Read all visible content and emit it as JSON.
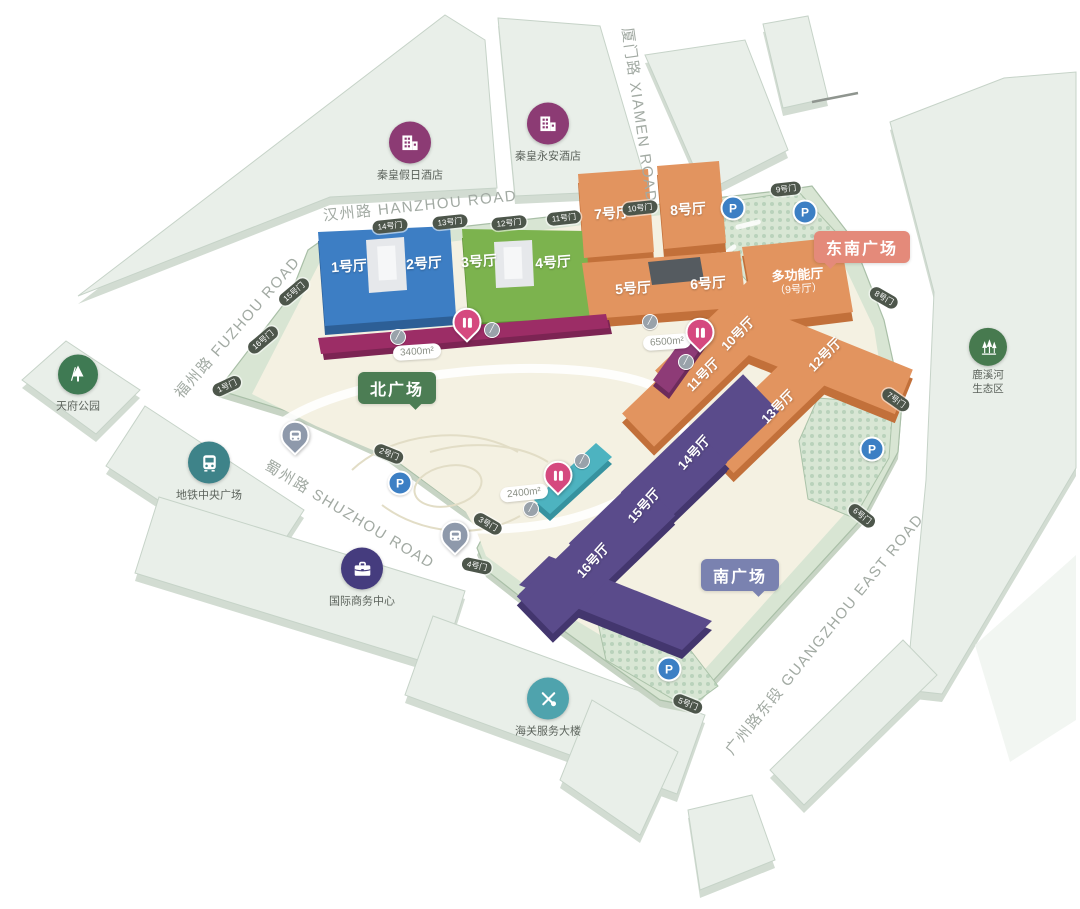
{
  "map": {
    "roads": {
      "hanzhou": {
        "label": "汉州路 HANZHOU ROAD"
      },
      "xiamen": {
        "label": "厦门路 XIAMEN ROAD"
      },
      "fuzhou": {
        "label": "福州路 FUZHOU ROAD"
      },
      "shuzhou": {
        "label": "蜀州路 SHUZHOU ROAD"
      },
      "guangzhou": {
        "label": "广州路东段 GUANGZHOU EAST ROAD"
      }
    },
    "halls": {
      "h1": {
        "label": "1号厅"
      },
      "h2": {
        "label": "2号厅"
      },
      "h3": {
        "label": "3号厅"
      },
      "h4": {
        "label": "4号厅"
      },
      "h5": {
        "label": "5号厅"
      },
      "h6": {
        "label": "6号厅"
      },
      "h7": {
        "label": "7号厅"
      },
      "h8": {
        "label": "8号厅"
      },
      "multi": {
        "line1": "多功能厅",
        "line2": "（9号厅）"
      },
      "h10": {
        "label": "10号厅"
      },
      "h11": {
        "label": "11号厅"
      },
      "h12": {
        "label": "12号厅"
      },
      "h13": {
        "label": "13号厅"
      },
      "h14": {
        "label": "14号厅"
      },
      "h15": {
        "label": "15号厅"
      },
      "h16": {
        "label": "16号厅"
      }
    },
    "plazas": {
      "north": {
        "label": "北广场",
        "color": "#4c7d54"
      },
      "southeast": {
        "label": "东南广场",
        "color": "#e48a7a"
      },
      "south": {
        "label": "南广场",
        "color": "#7a82b0"
      }
    },
    "gates": {
      "g1": {
        "label": "1号门"
      },
      "g2": {
        "label": "2号门"
      },
      "g3": {
        "label": "3号门"
      },
      "g4": {
        "label": "4号门"
      },
      "g5": {
        "label": "5号门"
      },
      "g6": {
        "label": "6号门"
      },
      "g7": {
        "label": "7号门"
      },
      "g8": {
        "label": "8号门"
      },
      "g9": {
        "label": "9号门"
      },
      "g10": {
        "label": "10号门"
      },
      "g11": {
        "label": "11号门"
      },
      "g12": {
        "label": "12号门"
      },
      "g13": {
        "label": "13号门"
      },
      "g14": {
        "label": "14号门"
      },
      "g15": {
        "label": "15号门"
      },
      "g16": {
        "label": "16号门"
      }
    },
    "areas": {
      "a3400": {
        "label": "3400m²"
      },
      "a6500": {
        "label": "6500m²"
      },
      "a2400": {
        "label": "2400m²"
      }
    },
    "landmarks": {
      "hotel_holiday": {
        "label": "秦皇假日酒店",
        "icon": "hotel-icon"
      },
      "hotel_yongan": {
        "label": "秦皇永安酒店",
        "icon": "hotel-icon"
      },
      "tianfu_park": {
        "label": "天府公园",
        "icon": "park-tree-icon"
      },
      "metro_plaza": {
        "label": "地铁中央广场",
        "icon": "metro-icon"
      },
      "business_center": {
        "label": "国际商务中心",
        "icon": "briefcase-icon"
      },
      "customs_building": {
        "label": "海关服务大楼",
        "icon": "customs-icon"
      },
      "luxi_eco": {
        "line1": "鹿溪河",
        "line2": "生态区",
        "icon": "eco-trees-icon"
      }
    },
    "markers": {
      "parking": {
        "label": "P",
        "count": 5,
        "color": "#3c7fc4"
      },
      "restaurant": {
        "icon": "fork-knife-icon",
        "count": 3,
        "color": "#d5497f"
      },
      "bus": {
        "icon": "bus-icon",
        "count": 2,
        "color": "#8e99ab"
      },
      "walkway": {
        "icon": "escalator-icon",
        "count": 6,
        "color": "#99a2aa"
      }
    },
    "colors": {
      "hall_blue": "#3d7ec4",
      "hall_green": "#7cb34e",
      "hall_orange": "#e2945f",
      "hall_purple": "#5a4b8b",
      "strip_magenta": "#9c2d66",
      "strip_teal": "#4db3c0",
      "site_green": "#d8e5d3",
      "plaza_beige": "#f4f1e2"
    }
  }
}
